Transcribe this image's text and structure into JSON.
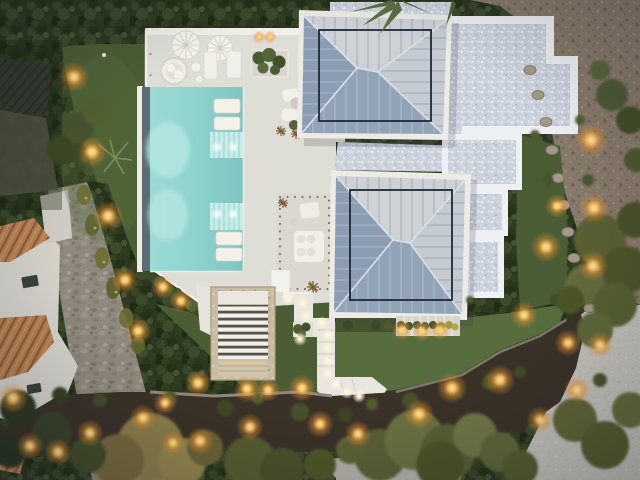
{
  "scene": {
    "caption": "Aerial top-down dusk view of a modern white villa: turquoise pool with sun loungers, two standing-seam hip roofs, white gravel courtyards, lawns, stone stair, zigzag lit walkway, neighbouring terracotta-roof house, hedges, trees and warm garden lights",
    "objects": {
      "umbrellas": 2,
      "pool_loungers": 4,
      "terrace_loungers": 2,
      "hip_roofs": 2,
      "egg_chair": 1,
      "stair": 1
    }
  },
  "palette": {
    "water": "#8ed3ce",
    "water_deep": "#7cc5c1",
    "water_shelf": "#c6ece7",
    "pool_edge_dark": "#5d6c73",
    "pool_lip": "#eceae3",
    "deck": "#deddd6",
    "deck_wall": "#f2f0ea",
    "patio": "#dcd8d0",
    "lawn": "#4b5d33",
    "lawn_light": "#586d3c",
    "hedge": "#2c3720",
    "gravel_wall": "#eef0f3",
    "roof_fascia": "#ecebe6",
    "roof_dark": "#8b9db4",
    "roof_dark2": "#91a3b7",
    "roof_pale": "#ced2d7",
    "roof_mid": "#c5cbd2",
    "roof_line": "#1f2837",
    "dirt": "#87796a",
    "road": "#c4c1ba",
    "road2": "#b3b0a8",
    "stone_path": "#8f897d",
    "mulch": "#3a3228",
    "stair_stone": "#cabda3",
    "slat_white": "#f2efe9",
    "terracotta": "#b8804f",
    "light_warm": "#ffc963",
    "light_core": "#ffd88f"
  },
  "lights": {
    "warm": [
      [
        74,
        77,
        9
      ],
      [
        92,
        152,
        9
      ],
      [
        108,
        216,
        9
      ],
      [
        125,
        280,
        8
      ],
      [
        138,
        331,
        8
      ],
      [
        163,
        287,
        7
      ],
      [
        181,
        301,
        7
      ],
      [
        198,
        383,
        8
      ],
      [
        247,
        389,
        8
      ],
      [
        302,
        388,
        8
      ],
      [
        13,
        398,
        9
      ],
      [
        30,
        446,
        8
      ],
      [
        58,
        452,
        8
      ],
      [
        90,
        433,
        8
      ],
      [
        143,
        418,
        8
      ],
      [
        165,
        403,
        7
      ],
      [
        173,
        443,
        7
      ],
      [
        200,
        441,
        8
      ],
      [
        250,
        427,
        8
      ],
      [
        268,
        390,
        7
      ],
      [
        320,
        424,
        8
      ],
      [
        358,
        434,
        8
      ],
      [
        419,
        414,
        9
      ],
      [
        452,
        388,
        9
      ],
      [
        500,
        380,
        9
      ],
      [
        540,
        420,
        8
      ],
      [
        568,
        343,
        8
      ],
      [
        524,
        315,
        8
      ],
      [
        546,
        247,
        9
      ],
      [
        557,
        206,
        7
      ],
      [
        591,
        140,
        10
      ],
      [
        594,
        208,
        9
      ],
      [
        593,
        266,
        9
      ],
      [
        600,
        345,
        8
      ],
      [
        577,
        390,
        8
      ],
      [
        402,
        330,
        6
      ],
      [
        422,
        331,
        6
      ],
      [
        440,
        330,
        6
      ],
      [
        259,
        37,
        4
      ],
      [
        270,
        37,
        4
      ]
    ],
    "path": [
      [
        288,
        299
      ],
      [
        303,
        303
      ],
      [
        306,
        316
      ],
      [
        322,
        323
      ],
      [
        328,
        335
      ],
      [
        328,
        348
      ],
      [
        328,
        361
      ],
      [
        328,
        373
      ],
      [
        336,
        384
      ],
      [
        347,
        392
      ],
      [
        359,
        396
      ],
      [
        300,
        339
      ]
    ],
    "pool": [
      [
        217,
        147
      ],
      [
        233,
        147
      ],
      [
        217,
        214
      ],
      [
        233,
        214
      ]
    ]
  },
  "vegetation": {
    "trees": [
      [
        150,
        447,
        34,
        "#8a7c48"
      ],
      [
        118,
        460,
        26,
        "#77683c"
      ],
      [
        182,
        462,
        24,
        "#93854e"
      ],
      [
        205,
        448,
        18,
        "#6d6236"
      ],
      [
        250,
        462,
        26,
        "#555c2f"
      ],
      [
        282,
        470,
        22,
        "#49512a"
      ],
      [
        380,
        455,
        26,
        "#5a6134"
      ],
      [
        415,
        440,
        30,
        "#6b7140"
      ],
      [
        448,
        452,
        28,
        "#585e30"
      ],
      [
        475,
        435,
        22,
        "#6f7544"
      ],
      [
        440,
        465,
        24,
        "#4c5228"
      ],
      [
        500,
        452,
        20,
        "#5f6638"
      ],
      [
        520,
        468,
        18,
        "#555c2e"
      ],
      [
        600,
        240,
        26,
        "#5a6132"
      ],
      [
        625,
        270,
        24,
        "#4e5629"
      ],
      [
        585,
        285,
        20,
        "#646a3a"
      ],
      [
        615,
        305,
        22,
        "#566030"
      ],
      [
        635,
        220,
        18,
        "#49512a"
      ],
      [
        595,
        330,
        18,
        "#5f6838"
      ],
      [
        570,
        300,
        14,
        "#4b5426"
      ],
      [
        575,
        420,
        22,
        "#5f6535"
      ],
      [
        605,
        445,
        24,
        "#545b2d"
      ],
      [
        630,
        410,
        18,
        "#656b3a"
      ],
      [
        612,
        95,
        16,
        "#4e5a34"
      ],
      [
        630,
        120,
        14,
        "#435026"
      ],
      [
        600,
        70,
        10,
        "#57633a"
      ],
      [
        636,
        160,
        12,
        "#50592e"
      ],
      [
        52,
        432,
        20,
        "#39422a"
      ],
      [
        18,
        408,
        18,
        "#2f3722"
      ],
      [
        88,
        455,
        18,
        "#434e2c"
      ],
      [
        10,
        452,
        16,
        "#2b3420"
      ],
      [
        78,
        128,
        16,
        "#46532d"
      ],
      [
        60,
        150,
        14,
        "#3a4724"
      ],
      [
        95,
        112,
        12,
        "#52602f"
      ],
      [
        320,
        465,
        16,
        "#4f5628"
      ],
      [
        350,
        450,
        14,
        "#5d6433"
      ]
    ],
    "shrubs": [
      [
        170,
        398,
        7,
        "#4a5229"
      ],
      [
        225,
        408,
        8,
        "#3f4824"
      ],
      [
        258,
        398,
        6,
        "#555e2c"
      ],
      [
        300,
        412,
        9,
        "#47512a"
      ],
      [
        345,
        415,
        7,
        "#3c4522"
      ],
      [
        372,
        404,
        6,
        "#515a2c"
      ],
      [
        410,
        400,
        8,
        "#46502a"
      ],
      [
        455,
        392,
        7,
        "#3d4724"
      ],
      [
        490,
        382,
        8,
        "#4b5428"
      ],
      [
        520,
        372,
        6,
        "#414b26"
      ],
      [
        60,
        395,
        8,
        "#36401f"
      ],
      [
        100,
        400,
        7,
        "#424c26"
      ],
      [
        540,
        250,
        6,
        "#4e5731"
      ],
      [
        548,
        180,
        5,
        "#46512b"
      ],
      [
        556,
        300,
        6,
        "#3f4a25"
      ],
      [
        588,
        180,
        6,
        "#4a5530"
      ],
      [
        580,
        120,
        5,
        "#515c33"
      ],
      [
        600,
        380,
        7,
        "#49532a"
      ],
      [
        535,
        135,
        5,
        "#4e5a30"
      ],
      [
        470,
        300,
        4,
        "#4c5830"
      ]
    ],
    "rocks": [
      [
        530,
        70
      ],
      [
        538,
        95
      ],
      [
        546,
        122
      ],
      [
        552,
        150
      ],
      [
        558,
        178
      ],
      [
        564,
        205
      ],
      [
        568,
        232
      ],
      [
        574,
        258
      ],
      [
        580,
        284
      ],
      [
        590,
        308
      ],
      [
        600,
        328
      ]
    ]
  }
}
